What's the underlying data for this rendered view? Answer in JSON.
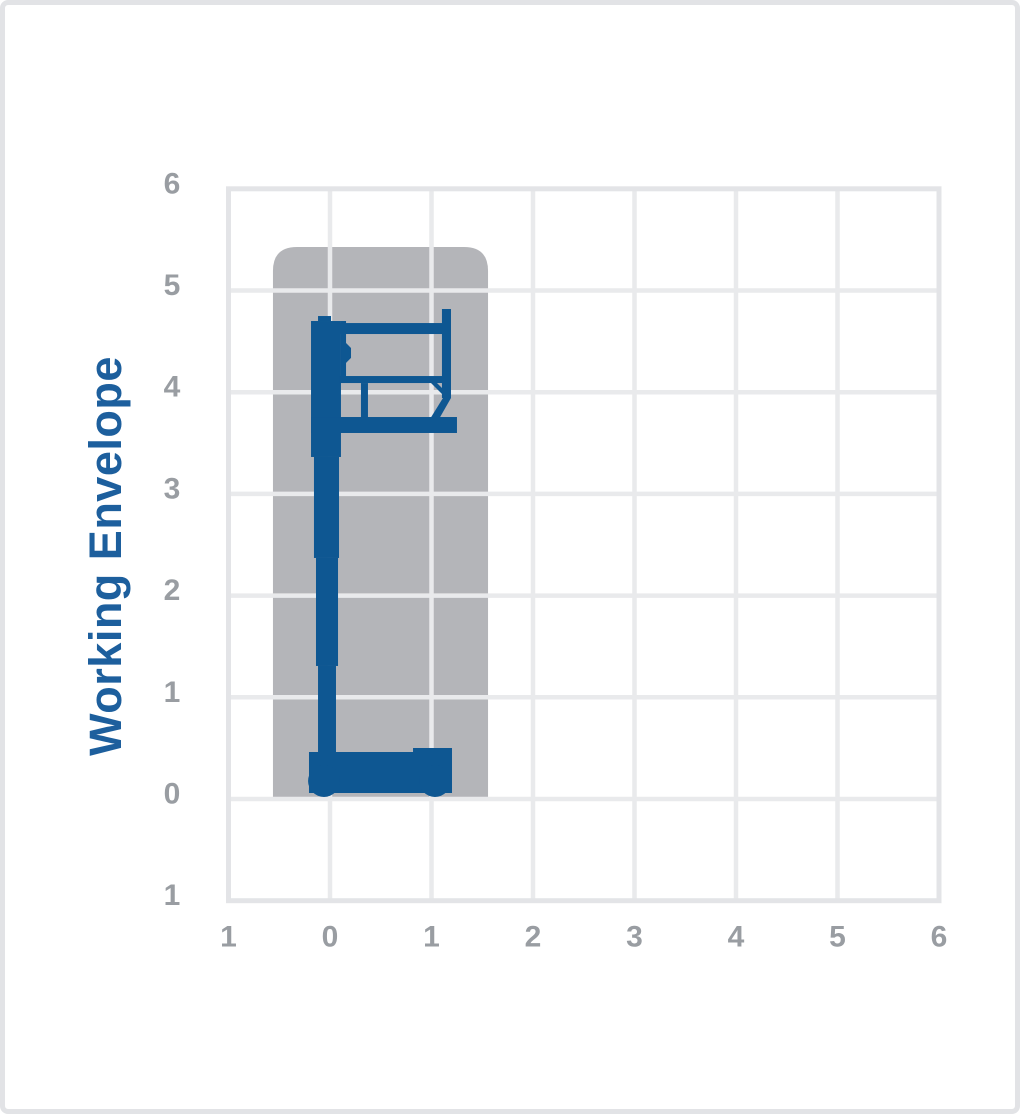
{
  "window": {
    "background": "#ffffff",
    "frame_border_color": "#e2e3e6"
  },
  "chart_data": {
    "type": "area",
    "title": "Working Envelope",
    "ylabel": "Working Envelope",
    "xlabel": "",
    "xlim": [
      -1,
      6
    ],
    "ylim": [
      -1,
      6
    ],
    "grid": true,
    "legend": false,
    "x_tick_values": [
      -1,
      0,
      1,
      2,
      3,
      4,
      5,
      6
    ],
    "x_tick_labels": [
      "1",
      "0",
      "1",
      "2",
      "3",
      "4",
      "5",
      "6"
    ],
    "y_tick_values": [
      -1,
      0,
      1,
      2,
      3,
      4,
      5,
      6
    ],
    "y_tick_labels": [
      "1",
      "0",
      "1",
      "2",
      "3",
      "4",
      "5",
      "6"
    ],
    "colors": {
      "title": "#1d5f9d",
      "machine": "#0e5792",
      "envelope": "#b4b5b9",
      "grid": "#e9eaec",
      "plot_border": "#e3e4e7",
      "tick_labels": "#999da2"
    },
    "envelope_region": {
      "x1": -0.562,
      "y1": 0,
      "x2": 1.557,
      "y2": 5.428,
      "top_corner_radius": 0.236
    },
    "machine_silhouette": {
      "rects": [
        {
          "name": "mast-section-upper",
          "x1": -0.187,
          "y1": 3.363,
          "x2": 0.108,
          "y2": 4.7
        },
        {
          "name": "mast-head-cap",
          "x1": -0.118,
          "y1": 4.7,
          "x2": 0.01,
          "y2": 4.749
        },
        {
          "name": "mast-head-side",
          "x1": 0.108,
          "y1": 4.12,
          "x2": 0.158,
          "y2": 4.7
        },
        {
          "name": "mast-section-2",
          "x1": -0.158,
          "y1": 2.37,
          "x2": 0.089,
          "y2": 3.363
        },
        {
          "name": "mast-section-3",
          "x1": -0.138,
          "y1": 1.308,
          "x2": 0.079,
          "y2": 2.37
        },
        {
          "name": "mast-section-4",
          "x1": -0.118,
          "y1": 0.462,
          "x2": 0.059,
          "y2": 1.308
        },
        {
          "name": "platform-top-rail",
          "x1": 0.049,
          "y1": 4.572,
          "x2": 1.143,
          "y2": 4.68
        },
        {
          "name": "platform-end-post",
          "x1": 1.103,
          "y1": 3.943,
          "x2": 1.192,
          "y2": 4.818
        },
        {
          "name": "platform-mid-rail",
          "x1": 0.089,
          "y1": 4.09,
          "x2": 1.133,
          "y2": 4.159
        },
        {
          "name": "rail-connector",
          "x1": 0.305,
          "y1": 3.746,
          "x2": 0.374,
          "y2": 4.09
        },
        {
          "name": "platform-deck",
          "x1": -0.187,
          "y1": 3.599,
          "x2": 1.251,
          "y2": 3.756
        }
      ],
      "polygons": [
        {
          "name": "mast-head-bump",
          "points": [
            [
              0.158,
              4.484
            ],
            [
              0.207,
              4.435
            ],
            [
              0.207,
              4.337
            ],
            [
              0.118,
              4.248
            ],
            [
              0.118,
              4.484
            ]
          ]
        },
        {
          "name": "post-diagonal-support",
          "points": [
            [
              1.113,
              3.943
            ],
            [
              1.192,
              3.943
            ],
            [
              1.074,
              3.736
            ],
            [
              0.985,
              3.736
            ]
          ]
        },
        {
          "name": "rail-gusset-strut",
          "points": [
            [
              0.995,
              4.09
            ],
            [
              1.054,
              4.09
            ],
            [
              1.192,
              3.953
            ],
            [
              1.133,
              3.953
            ]
          ]
        },
        {
          "name": "chassis-body",
          "points": [
            [
              -0.207,
              0.462
            ],
            [
              0.818,
              0.462
            ],
            [
              0.818,
              0.501
            ],
            [
              1.202,
              0.501
            ],
            [
              1.202,
              0.059
            ],
            [
              -0.207,
              0.059
            ]
          ]
        }
      ],
      "ellipses": [
        {
          "name": "wheel-left",
          "cx": -0.059,
          "cy": 0.177,
          "r": 0.157
        },
        {
          "name": "wheel-right",
          "cx": 1.034,
          "cy": 0.177,
          "r": 0.157
        }
      ]
    }
  }
}
